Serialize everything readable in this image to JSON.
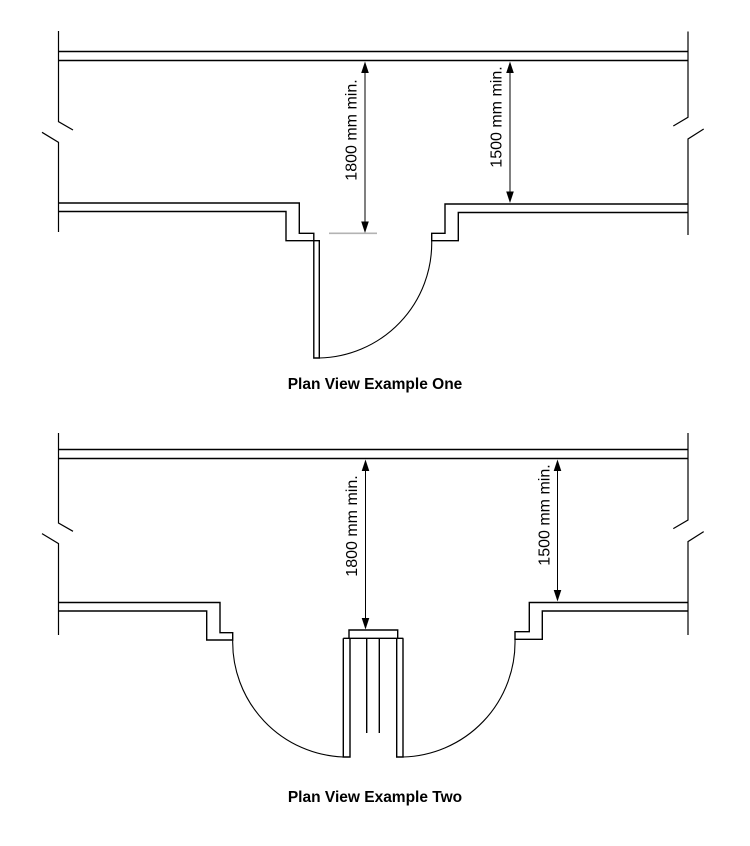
{
  "colors": {
    "line": "#000000",
    "dim_tick": "#b3b3b3",
    "background": "#ffffff"
  },
  "diagram_one": {
    "caption": "Plan View Example One",
    "dim_corridor": "1800 mm min.",
    "dim_recess": "1500 mm min."
  },
  "diagram_two": {
    "caption": "Plan View Example Two",
    "dim_corridor": "1800 mm min.",
    "dim_recess": "1500 mm min."
  }
}
